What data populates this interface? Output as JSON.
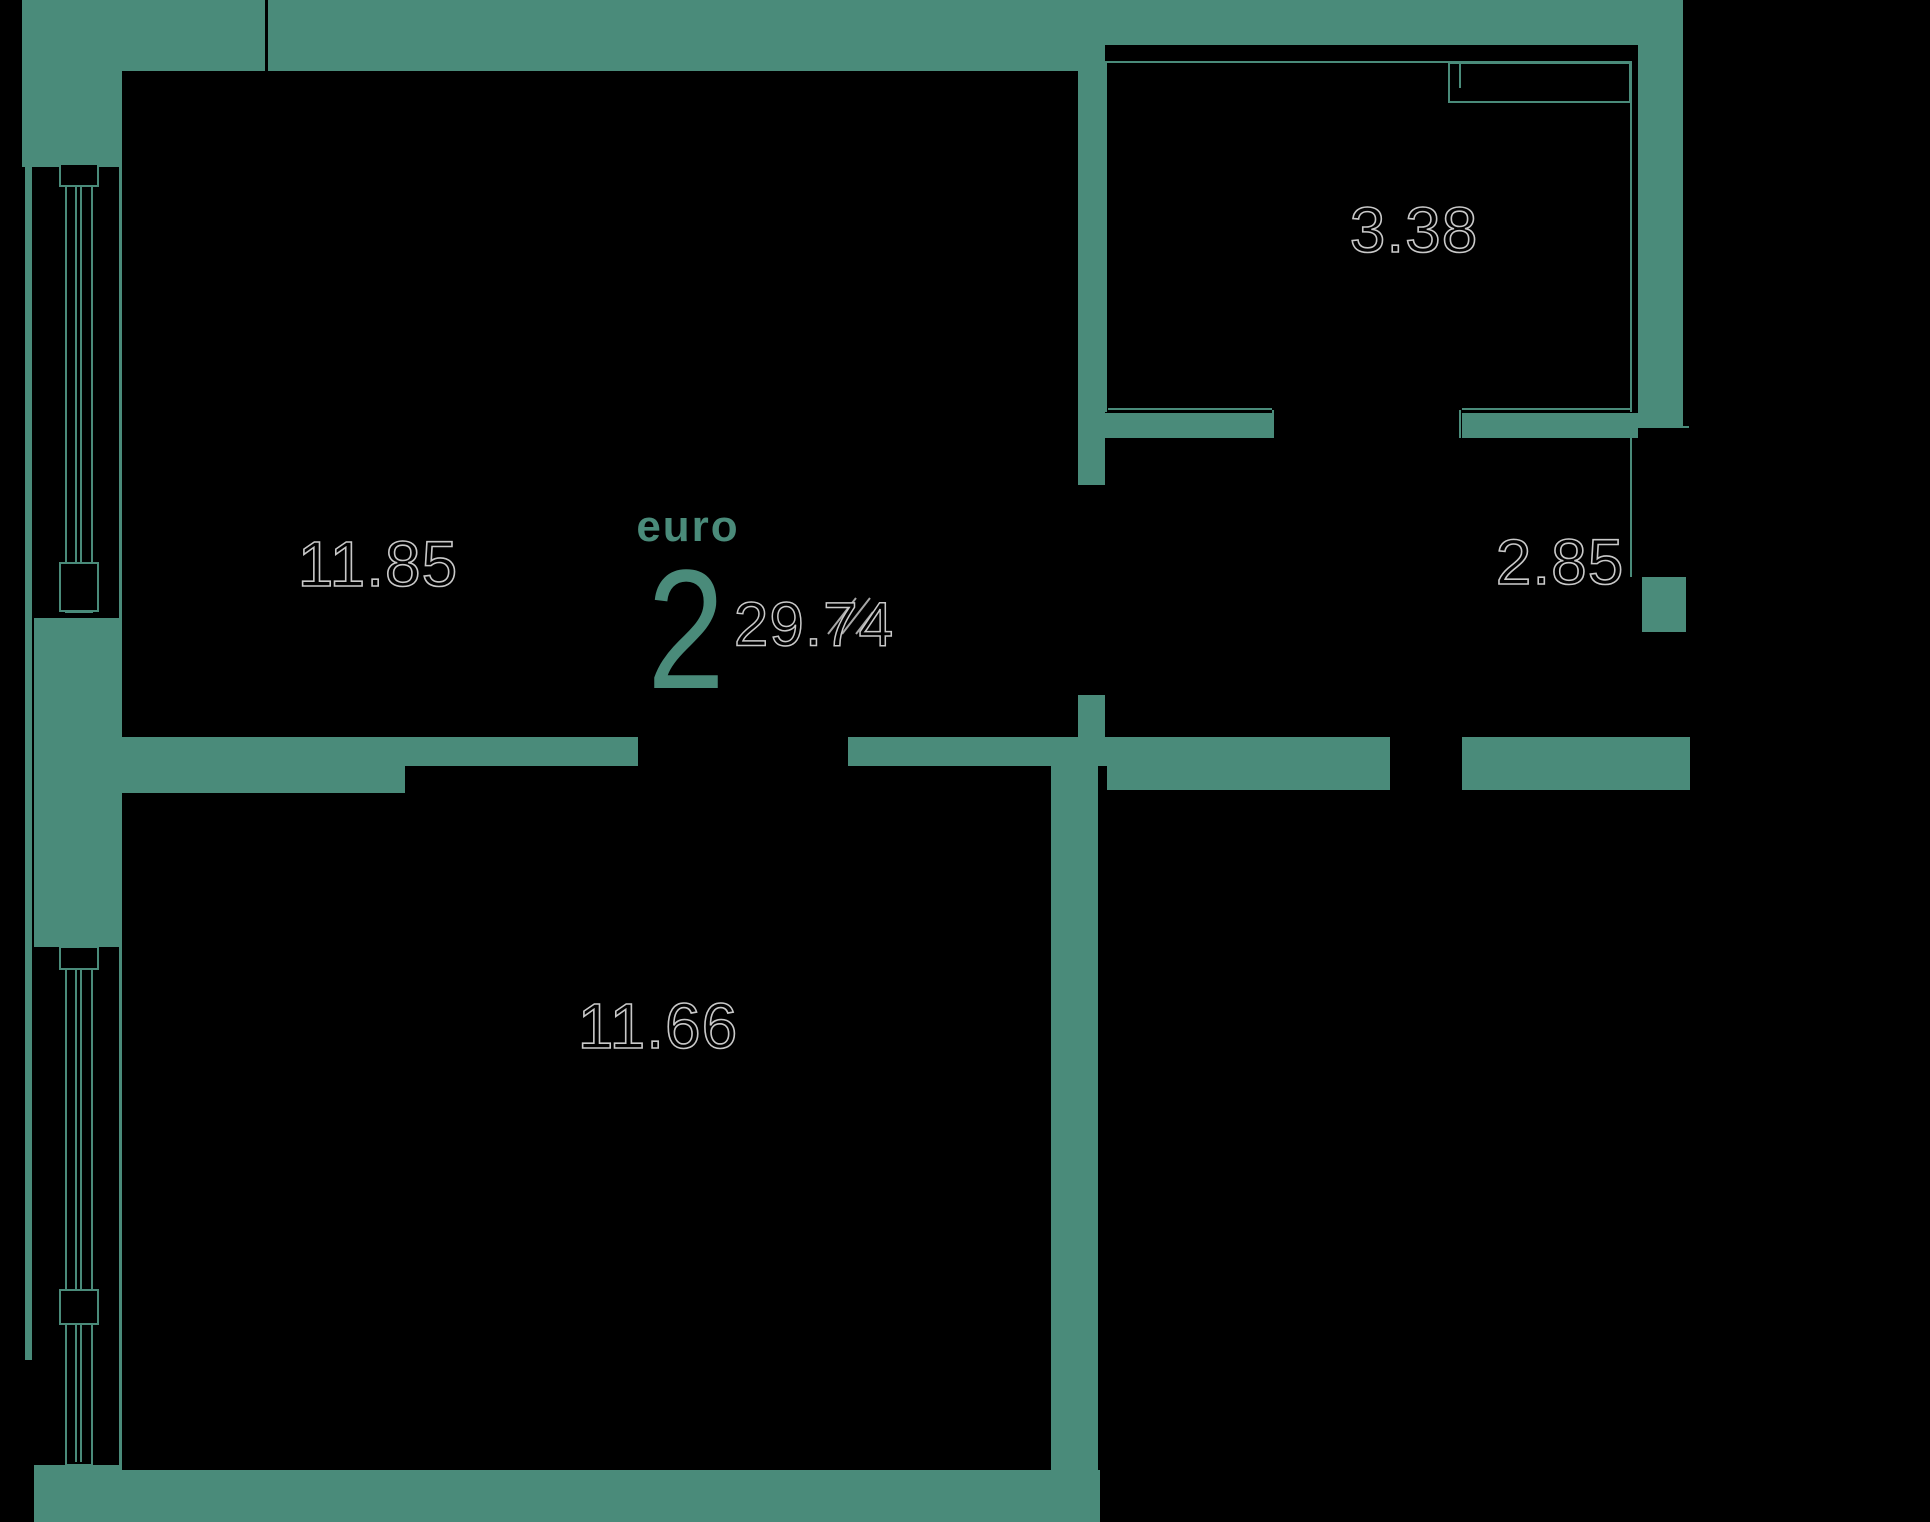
{
  "floorplan": {
    "unit_type_label": "euro",
    "unit_rooms_count": "2",
    "total_area": "29.74",
    "rooms": [
      {
        "name": "living-room",
        "area": "11.85"
      },
      {
        "name": "kitchen",
        "area": "3.38"
      },
      {
        "name": "hallway",
        "area": "2.85"
      },
      {
        "name": "bedroom",
        "area": "11.66"
      }
    ],
    "colors": {
      "wall": "#4A8B7A",
      "background": "#000000",
      "number_outline": "#C9C9C9",
      "accent_text": "#4A8B7A"
    }
  }
}
